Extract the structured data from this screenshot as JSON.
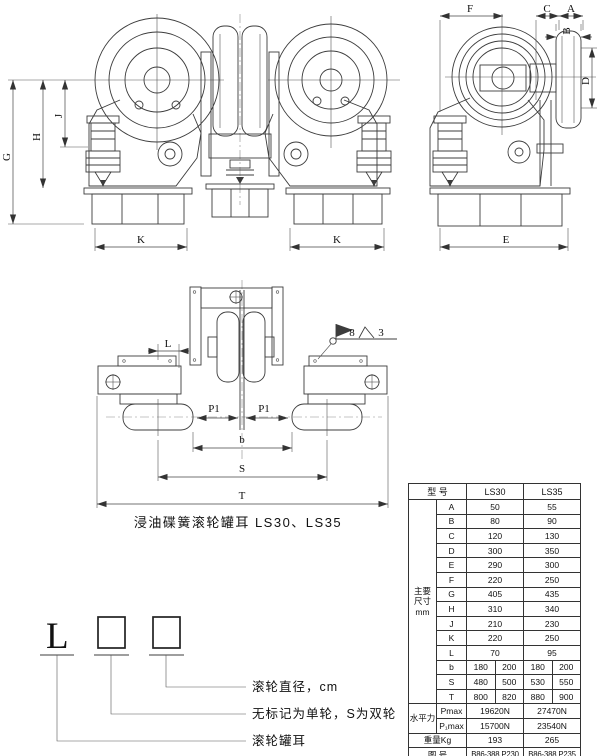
{
  "caption": "浸油碟簧滚轮罐耳 LS30、LS35",
  "dims": {
    "g": "G",
    "h": "H",
    "j": "J",
    "k_left": "K",
    "k_right": "K",
    "f": "F",
    "c": "C",
    "a": "A",
    "b_top": "B",
    "d": "D",
    "e": "E",
    "l_plan": "L",
    "p1_left": "P1",
    "p1_right": "P1",
    "b_plan": "b",
    "s": "S",
    "t": "T",
    "weld_number": "8",
    "weld_grade": "3"
  },
  "legend": {
    "prefix": "L",
    "callout_diameter": "滚轮直径，cm",
    "callout_type": "无标记为单轮，S为双轮",
    "callout_name": "滚轮罐耳"
  },
  "table": {
    "model_label": "型 号",
    "models": [
      "LS30",
      "LS35"
    ],
    "group_label": [
      "主要",
      "尺寸",
      "mm"
    ],
    "dim_rows": [
      {
        "k": "A",
        "v": [
          "50",
          "55"
        ]
      },
      {
        "k": "B",
        "v": [
          "80",
          "90"
        ]
      },
      {
        "k": "C",
        "v": [
          "120",
          "130"
        ]
      },
      {
        "k": "D",
        "v": [
          "300",
          "350"
        ]
      },
      {
        "k": "E",
        "v": [
          "290",
          "300"
        ]
      },
      {
        "k": "F",
        "v": [
          "220",
          "250"
        ]
      },
      {
        "k": "G",
        "v": [
          "405",
          "435"
        ]
      },
      {
        "k": "H",
        "v": [
          "310",
          "340"
        ]
      },
      {
        "k": "J",
        "v": [
          "210",
          "230"
        ]
      },
      {
        "k": "K",
        "v": [
          "220",
          "250"
        ]
      },
      {
        "k": "L",
        "v": [
          "70",
          "95"
        ]
      }
    ],
    "split_rows": [
      {
        "k": "b",
        "v": [
          "180",
          "200",
          "180",
          "200"
        ]
      },
      {
        "k": "S",
        "v": [
          "480",
          "500",
          "530",
          "550"
        ]
      },
      {
        "k": "T",
        "v": [
          "800",
          "820",
          "880",
          "900"
        ]
      }
    ],
    "force_label": "水平力",
    "force_rows": [
      {
        "k": "Pmax",
        "v": [
          "19620N",
          "27470N"
        ]
      },
      {
        "k": "P₁max",
        "v": [
          "15700N",
          "23540N"
        ]
      }
    ],
    "weight_label": "重量Kg",
    "weight": [
      "193",
      "265"
    ],
    "fig_label": "图 号",
    "figs": [
      "B86-388.P230",
      "B86-388.P235"
    ]
  }
}
